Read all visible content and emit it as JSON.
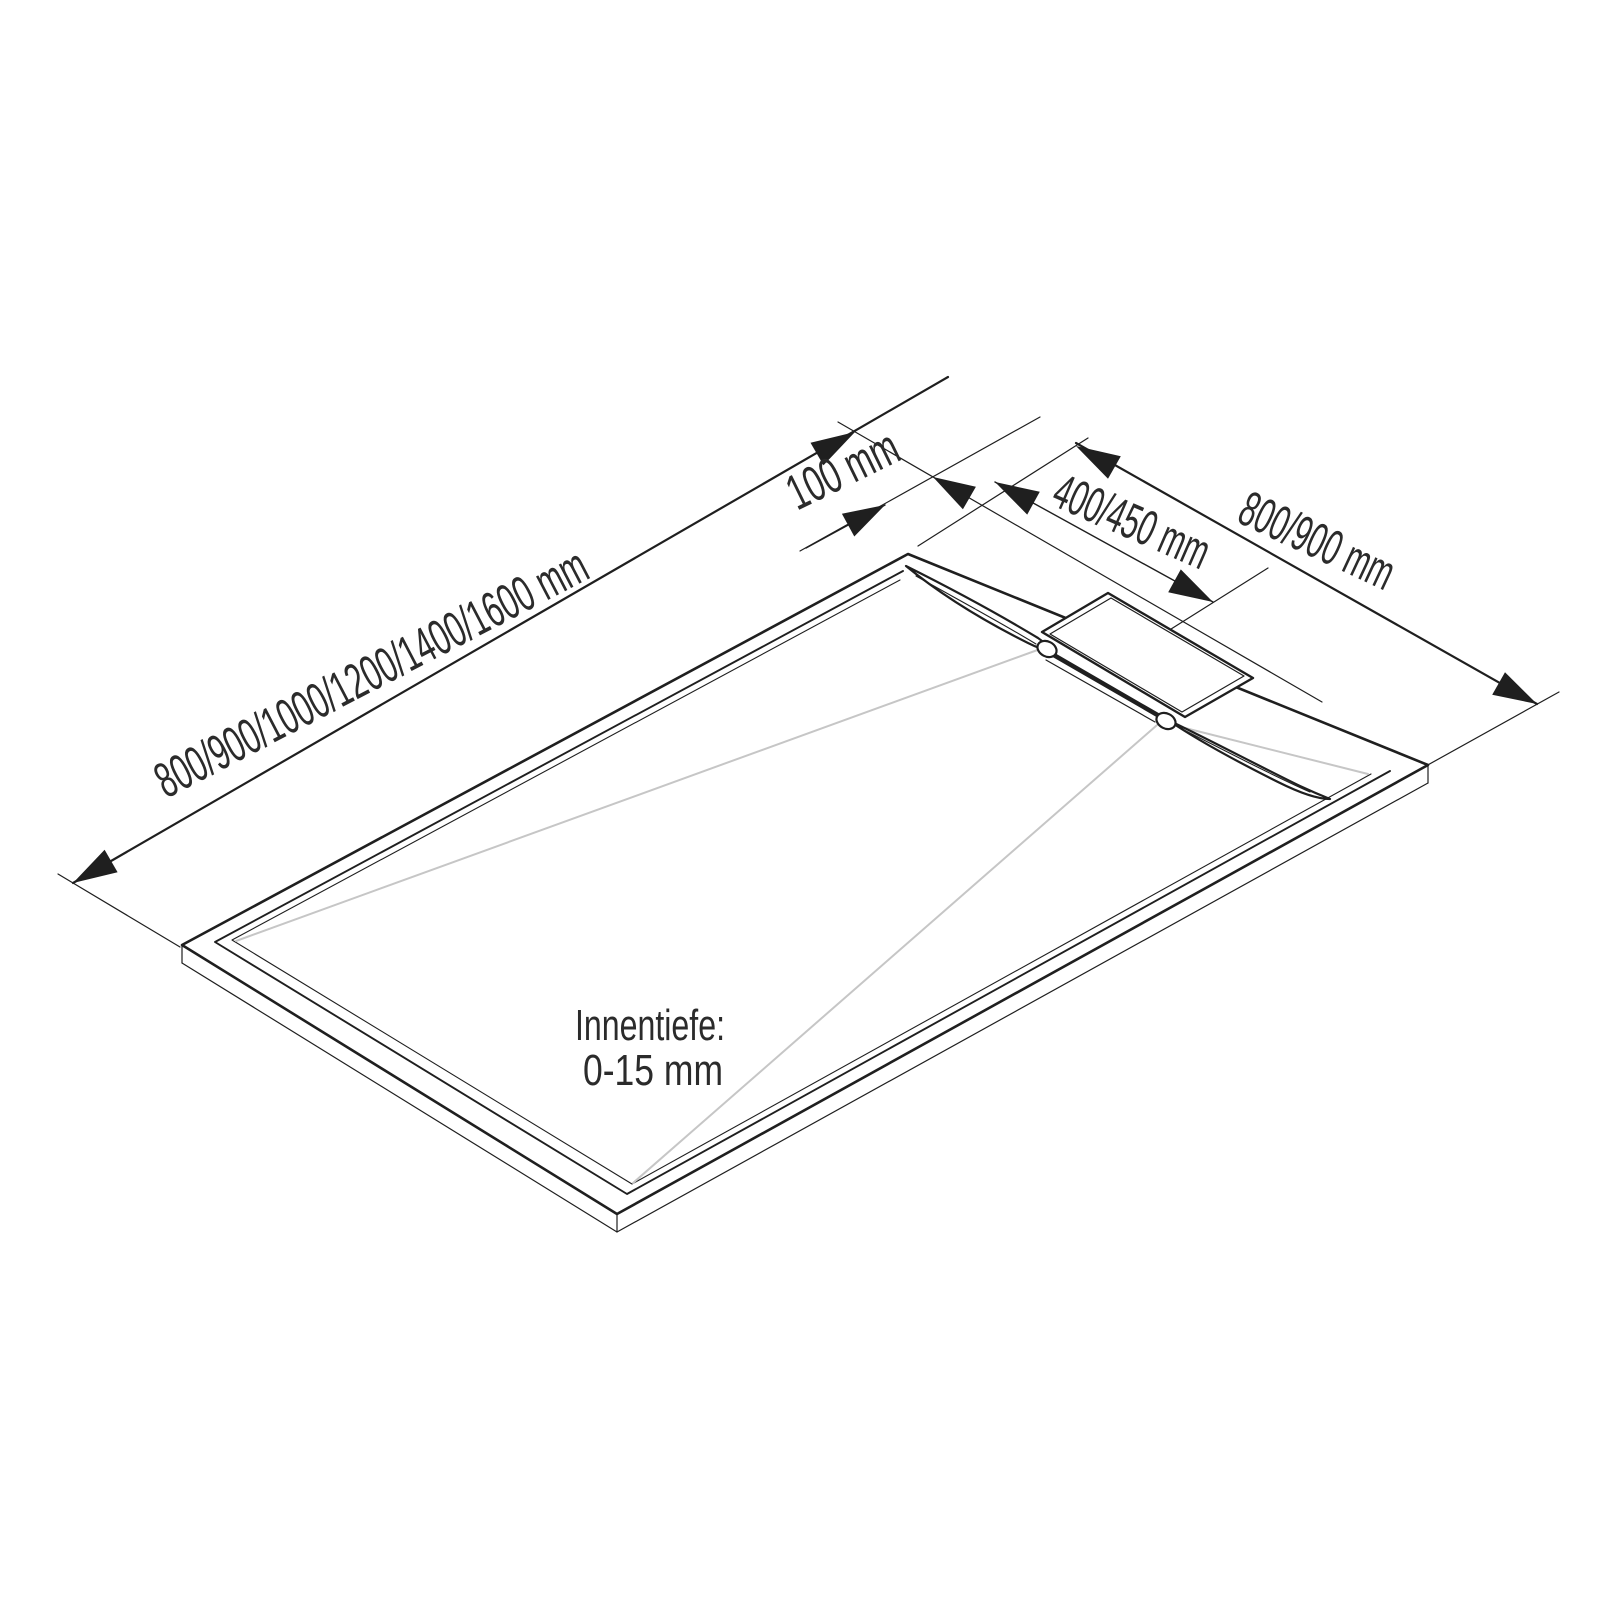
{
  "diagram": {
    "kind": "isometric technical drawing of a rectangular shower tray with linear drain",
    "labels": {
      "length_dimension": "800/900/1000/1200/1400/1600 mm",
      "offset_dimension": "100 mm",
      "drain_dimension": "400/450 mm",
      "width_dimension": "800/900 mm",
      "inner_depth_title": "Innentiefe:",
      "inner_depth_value": "0-15 mm"
    },
    "colors": {
      "line": "#1f1f1f",
      "slope_line": "#c6c6c6",
      "text": "#2b2b2b",
      "background": "#ffffff"
    }
  }
}
